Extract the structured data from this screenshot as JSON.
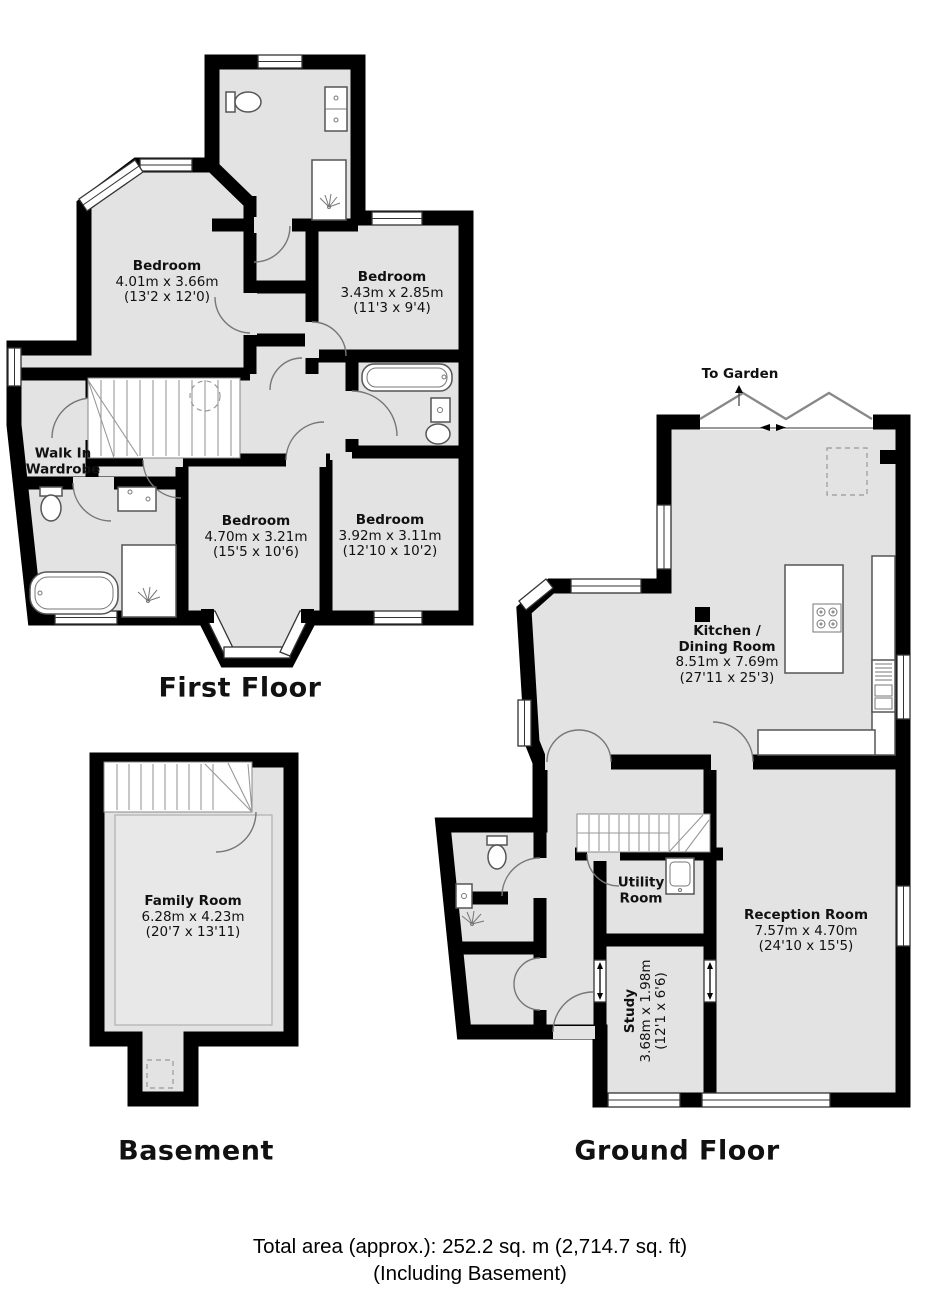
{
  "first_floor": {
    "label": "First Floor",
    "bedroom1": {
      "name": "Bedroom",
      "metric": "4.01m x 3.66m",
      "imperial": "(13'2 x 12'0)"
    },
    "bedroom2": {
      "name": "Bedroom",
      "metric": "3.43m x 2.85m",
      "imperial": "(11'3 x 9'4)"
    },
    "bedroom3": {
      "name": "Bedroom",
      "metric": "4.70m x 3.21m",
      "imperial": "(15'5 x 10'6)"
    },
    "bedroom4": {
      "name": "Bedroom",
      "metric": "3.92m x 3.11m",
      "imperial": "(12'10 x 10'2)"
    },
    "walk_in_wardrobe": {
      "line1": "Walk In",
      "line2": "Wardrobe"
    }
  },
  "basement": {
    "label": "Basement",
    "family_room": {
      "name": "Family Room",
      "metric": "6.28m x 4.23m",
      "imperial": "(20'7 x 13'11)"
    }
  },
  "ground_floor": {
    "label": "Ground Floor",
    "to_garden": "To Garden",
    "kitchen_dining": {
      "line1": "Kitchen /",
      "line2": "Dining Room",
      "metric": "8.51m x 7.69m",
      "imperial": "(27'11 x 25'3)"
    },
    "reception_room": {
      "name": "Reception Room",
      "metric": "7.57m x 4.70m",
      "imperial": "(24'10 x 15'5)"
    },
    "utility_room": {
      "line1": "Utility",
      "line2": "Room"
    },
    "study": {
      "name": "Study",
      "metric": "3.68m x 1.98m",
      "imperial": "(12'1 x 6'6)"
    }
  },
  "footer": {
    "line1": "Total area (approx.): 252.2 sq. m (2,714.7 sq. ft)",
    "line2": "(Including Basement)"
  },
  "colors": {
    "wall": "#000000",
    "floor": "#e3e3e3",
    "background": "#ffffff"
  }
}
